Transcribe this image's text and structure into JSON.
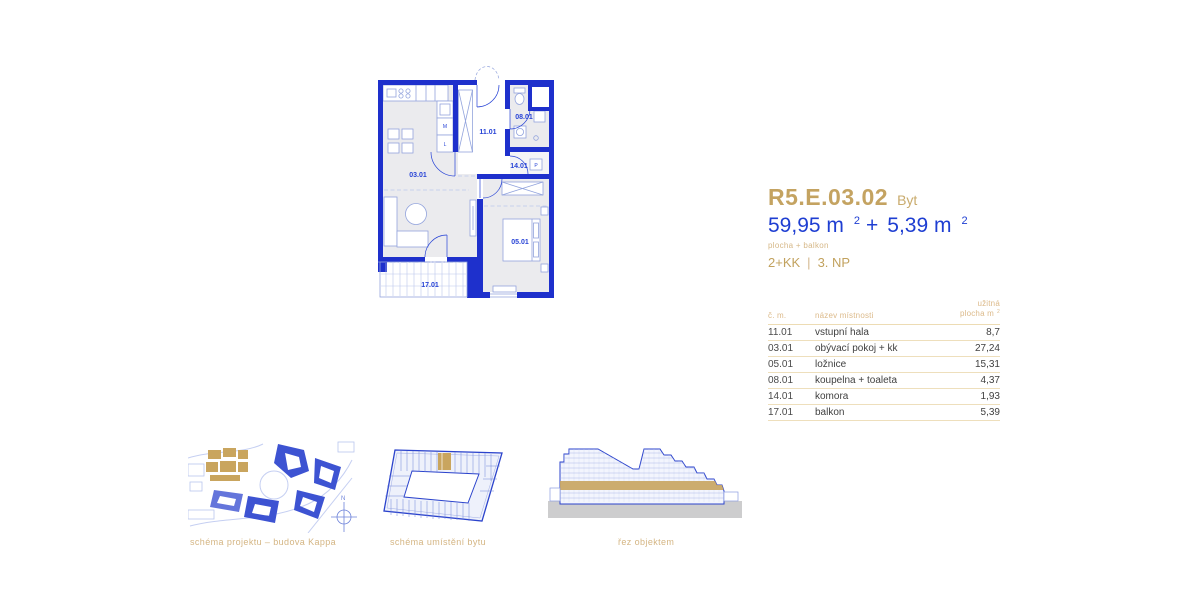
{
  "unit": {
    "code": "R5.E.03.02",
    "type_label": "Byt",
    "area_main": "59,95 m",
    "area_main_sup": "2",
    "area_plus": "+",
    "area_balcony": "5,39 m",
    "area_balcony_sup": "2",
    "area_note": "plocha + balkon",
    "layout": "2+KK",
    "separator": "|",
    "floor": "3. NP"
  },
  "floorplan": {
    "labels": {
      "living": "03.01",
      "hall": "11.01",
      "bathroom": "08.01",
      "storage": "14.01",
      "bedroom": "05.01",
      "balcony": "17.01"
    },
    "appliance_icons": {
      "dishwasher": "M",
      "fridge": "L",
      "washer": "P"
    }
  },
  "table": {
    "headers": {
      "number": "č. m.",
      "name": "název místnosti",
      "area_line1": "užitná",
      "area_line2": "plocha m",
      "area_sup": "2"
    },
    "rows": [
      {
        "number": "11.01",
        "name": "vstupní hala",
        "area": "8,7"
      },
      {
        "number": "03.01",
        "name": "obývací pokoj + kk",
        "area": "27,24"
      },
      {
        "number": "05.01",
        "name": "ložnice",
        "area": "15,31"
      },
      {
        "number": "08.01",
        "name": "koupelna + toaleta",
        "area": "4,37"
      },
      {
        "number": "14.01",
        "name": "komora",
        "area": "1,93"
      },
      {
        "number": "17.01",
        "name": "balkon",
        "area": "5,39"
      }
    ]
  },
  "diagrams": {
    "site": {
      "caption": "schéma projektu – budova Kappa",
      "compass_label": "N"
    },
    "location": {
      "caption": "schéma umístění bytu"
    },
    "section": {
      "caption": "řez objektem"
    }
  },
  "colors": {
    "accent_gold": "#c4a361",
    "accent_blue": "#1e3ed2",
    "wall_blue": "#1e30cc"
  }
}
